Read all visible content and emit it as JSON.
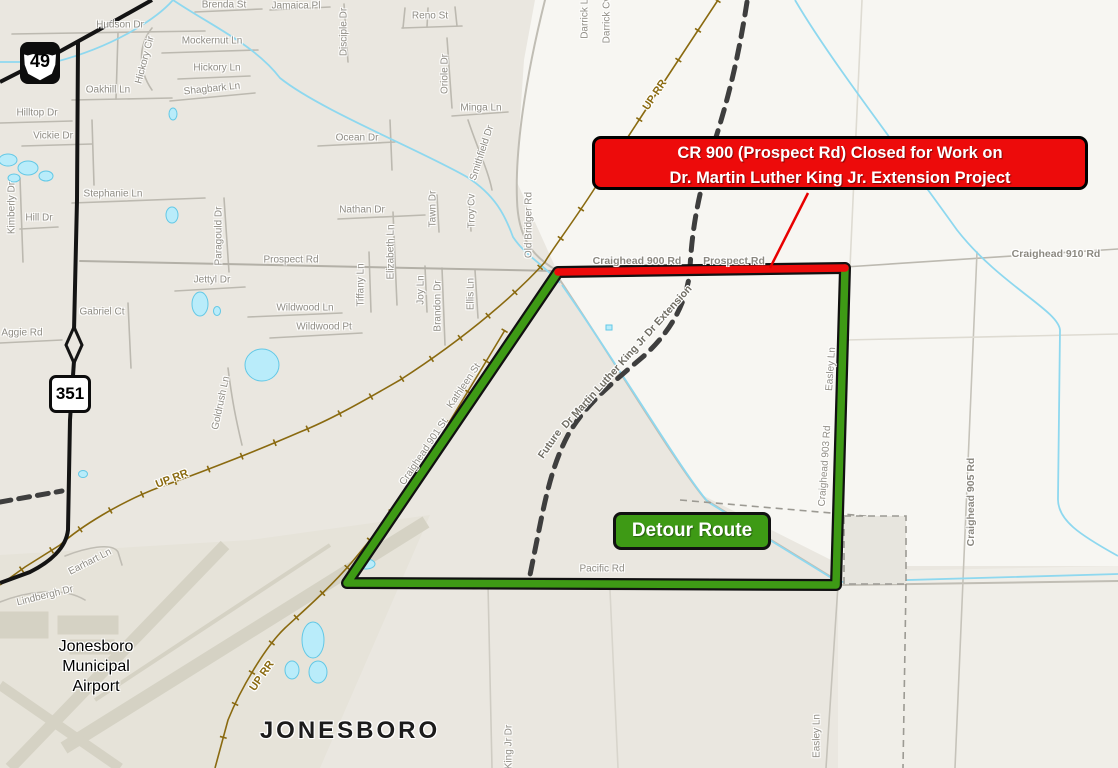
{
  "map": {
    "banner": {
      "line1": "CR 900 (Prospect Rd) Closed for Work on",
      "line2": "Dr. Martin Luther King Jr. Extension Project"
    },
    "detour_label": {
      "text": "Detour Route"
    },
    "shields": {
      "us49": "49",
      "ar351": "351"
    },
    "colors": {
      "closure_red": "#ed0b0b",
      "detour_green": "#3e9a15",
      "railroad_brown": "#8a6a10",
      "water_blue": "#8ed8ef",
      "future_road_gray": "#3e3e3e",
      "map_background": "#eae7e0"
    },
    "labels": [
      {
        "t": "JONESBORO",
        "x": 350,
        "y": 731,
        "r": 0,
        "c": "city"
      },
      {
        "t": "Jonesboro",
        "x": 96,
        "y": 647,
        "r": 0,
        "c": "apt"
      },
      {
        "t": "Municipal",
        "x": 96,
        "y": 667,
        "r": 0,
        "c": "apt"
      },
      {
        "t": "Airport",
        "x": 96,
        "y": 687,
        "r": 0,
        "c": "apt"
      },
      {
        "t": "UP RR",
        "x": 655,
        "y": 95,
        "r": -56,
        "c": "rr"
      },
      {
        "t": "UP RR",
        "x": 172,
        "y": 479,
        "r": -21,
        "c": "rr"
      },
      {
        "t": "UP RR",
        "x": 262,
        "y": 676,
        "r": -55,
        "c": "rr"
      },
      {
        "t": "Hudson Dr",
        "x": 120,
        "y": 25,
        "r": 0,
        "c": ""
      },
      {
        "t": "Brenda St",
        "x": 224,
        "y": 5,
        "r": 0,
        "c": ""
      },
      {
        "t": "Jamaica Pl",
        "x": 296,
        "y": 6,
        "r": 0,
        "c": ""
      },
      {
        "t": "Mockernut Ln",
        "x": 212,
        "y": 41,
        "r": 0,
        "c": ""
      },
      {
        "t": "Hickory Cir",
        "x": 145,
        "y": 60,
        "r": -75,
        "c": ""
      },
      {
        "t": "Hickory Ln",
        "x": 217,
        "y": 68,
        "r": 0,
        "c": ""
      },
      {
        "t": "Shagbark Ln",
        "x": 212,
        "y": 89,
        "r": -6,
        "c": ""
      },
      {
        "t": "Oakhill Ln",
        "x": 108,
        "y": 90,
        "r": 0,
        "c": ""
      },
      {
        "t": "Hilltop Dr",
        "x": 37,
        "y": 113,
        "r": 0,
        "c": ""
      },
      {
        "t": "Vickie Dr",
        "x": 53,
        "y": 136,
        "r": 0,
        "c": ""
      },
      {
        "t": "Stephanie Ln",
        "x": 113,
        "y": 194,
        "r": 0,
        "c": ""
      },
      {
        "t": "Kimberly Dr",
        "x": 12,
        "y": 208,
        "r": -90,
        "c": ""
      },
      {
        "t": "Hill Dr",
        "x": 39,
        "y": 218,
        "r": 0,
        "c": ""
      },
      {
        "t": "Disciple Dr",
        "x": 344,
        "y": 32,
        "r": -90,
        "c": ""
      },
      {
        "t": "Reno St",
        "x": 430,
        "y": 16,
        "r": 0,
        "c": ""
      },
      {
        "t": "Oriole Dr",
        "x": 445,
        "y": 74,
        "r": -90,
        "c": ""
      },
      {
        "t": "Minga Ln",
        "x": 481,
        "y": 108,
        "r": 0,
        "c": ""
      },
      {
        "t": "Smithfield Dr",
        "x": 482,
        "y": 153,
        "r": -72,
        "c": ""
      },
      {
        "t": "Ocean Dr",
        "x": 357,
        "y": 138,
        "r": 0,
        "c": ""
      },
      {
        "t": "Darrick Ln",
        "x": 585,
        "y": 16,
        "r": -90,
        "c": ""
      },
      {
        "t": "Darrick Cv",
        "x": 607,
        "y": 20,
        "r": -90,
        "c": ""
      },
      {
        "t": "Nathan Dr",
        "x": 362,
        "y": 210,
        "r": 0,
        "c": ""
      },
      {
        "t": "Tawn Dr",
        "x": 433,
        "y": 209,
        "r": -90,
        "c": ""
      },
      {
        "t": "Troy Cv",
        "x": 472,
        "y": 211,
        "r": -90,
        "c": ""
      },
      {
        "t": "Old Bridger Rd",
        "x": 529,
        "y": 225,
        "r": -90,
        "c": ""
      },
      {
        "t": "Prospect Rd",
        "x": 291,
        "y": 260,
        "r": 0,
        "c": ""
      },
      {
        "t": "Elizabeth Ln",
        "x": 391,
        "y": 252,
        "r": -90,
        "c": ""
      },
      {
        "t": "Tiffany Ln",
        "x": 361,
        "y": 285,
        "r": -90,
        "c": ""
      },
      {
        "t": "Joy Ln",
        "x": 421,
        "y": 290,
        "r": -90,
        "c": ""
      },
      {
        "t": "Brandon Dr",
        "x": 438,
        "y": 306,
        "r": -90,
        "c": ""
      },
      {
        "t": "Ellis Ln",
        "x": 471,
        "y": 294,
        "r": -90,
        "c": ""
      },
      {
        "t": "Wildwood Ln",
        "x": 305,
        "y": 308,
        "r": 0,
        "c": ""
      },
      {
        "t": "Wildwood Pt",
        "x": 324,
        "y": 327,
        "r": 0,
        "c": ""
      },
      {
        "t": "Paragould Dr",
        "x": 219,
        "y": 236,
        "r": -90,
        "c": ""
      },
      {
        "t": "Jettyl Dr",
        "x": 212,
        "y": 280,
        "r": 0,
        "c": ""
      },
      {
        "t": "Gabriel Ct",
        "x": 102,
        "y": 312,
        "r": 0,
        "c": ""
      },
      {
        "t": "Aggie Rd",
        "x": 22,
        "y": 333,
        "r": 0,
        "c": ""
      },
      {
        "t": "Goldrush Ln",
        "x": 221,
        "y": 403,
        "r": -78,
        "c": ""
      },
      {
        "t": "Earhart Ln",
        "x": 90,
        "y": 562,
        "r": -27,
        "c": ""
      },
      {
        "t": "Lindbergh Dr",
        "x": 45,
        "y": 596,
        "r": -14,
        "c": ""
      },
      {
        "t": "Craighead 900 Rd",
        "x": 637,
        "y": 261,
        "r": 0,
        "c": "stlg"
      },
      {
        "t": "Prospect Rd",
        "x": 734,
        "y": 261,
        "r": 0,
        "c": "stlg"
      },
      {
        "t": "Craighead 910 Rd",
        "x": 1056,
        "y": 254,
        "r": 0,
        "c": "stlg"
      },
      {
        "t": "Craighead 905 Rd",
        "x": 971,
        "y": 502,
        "r": -90,
        "c": "stlg"
      },
      {
        "t": "Easley Ln",
        "x": 831,
        "y": 369,
        "r": -86,
        "c": ""
      },
      {
        "t": "Craighead 903 Rd",
        "x": 825,
        "y": 466,
        "r": -86,
        "c": ""
      },
      {
        "t": "Easley Ln",
        "x": 817,
        "y": 736,
        "r": -90,
        "c": ""
      },
      {
        "t": "King Jr Dr",
        "x": 509,
        "y": 747,
        "r": -90,
        "c": ""
      },
      {
        "t": "Craighead 901 St",
        "x": 424,
        "y": 452,
        "r": -56,
        "c": ""
      },
      {
        "t": "Kathleen St",
        "x": 464,
        "y": 386,
        "r": -56,
        "c": ""
      },
      {
        "t": "Future",
        "x": 550,
        "y": 444,
        "r": -55,
        "c": "future"
      },
      {
        "t": "Dr Martin Luther King Jr Dr Extension",
        "x": 627,
        "y": 357,
        "r": -48,
        "c": "future"
      },
      {
        "t": "Pacific Rd",
        "x": 602,
        "y": 569,
        "r": 0,
        "c": ""
      }
    ]
  }
}
